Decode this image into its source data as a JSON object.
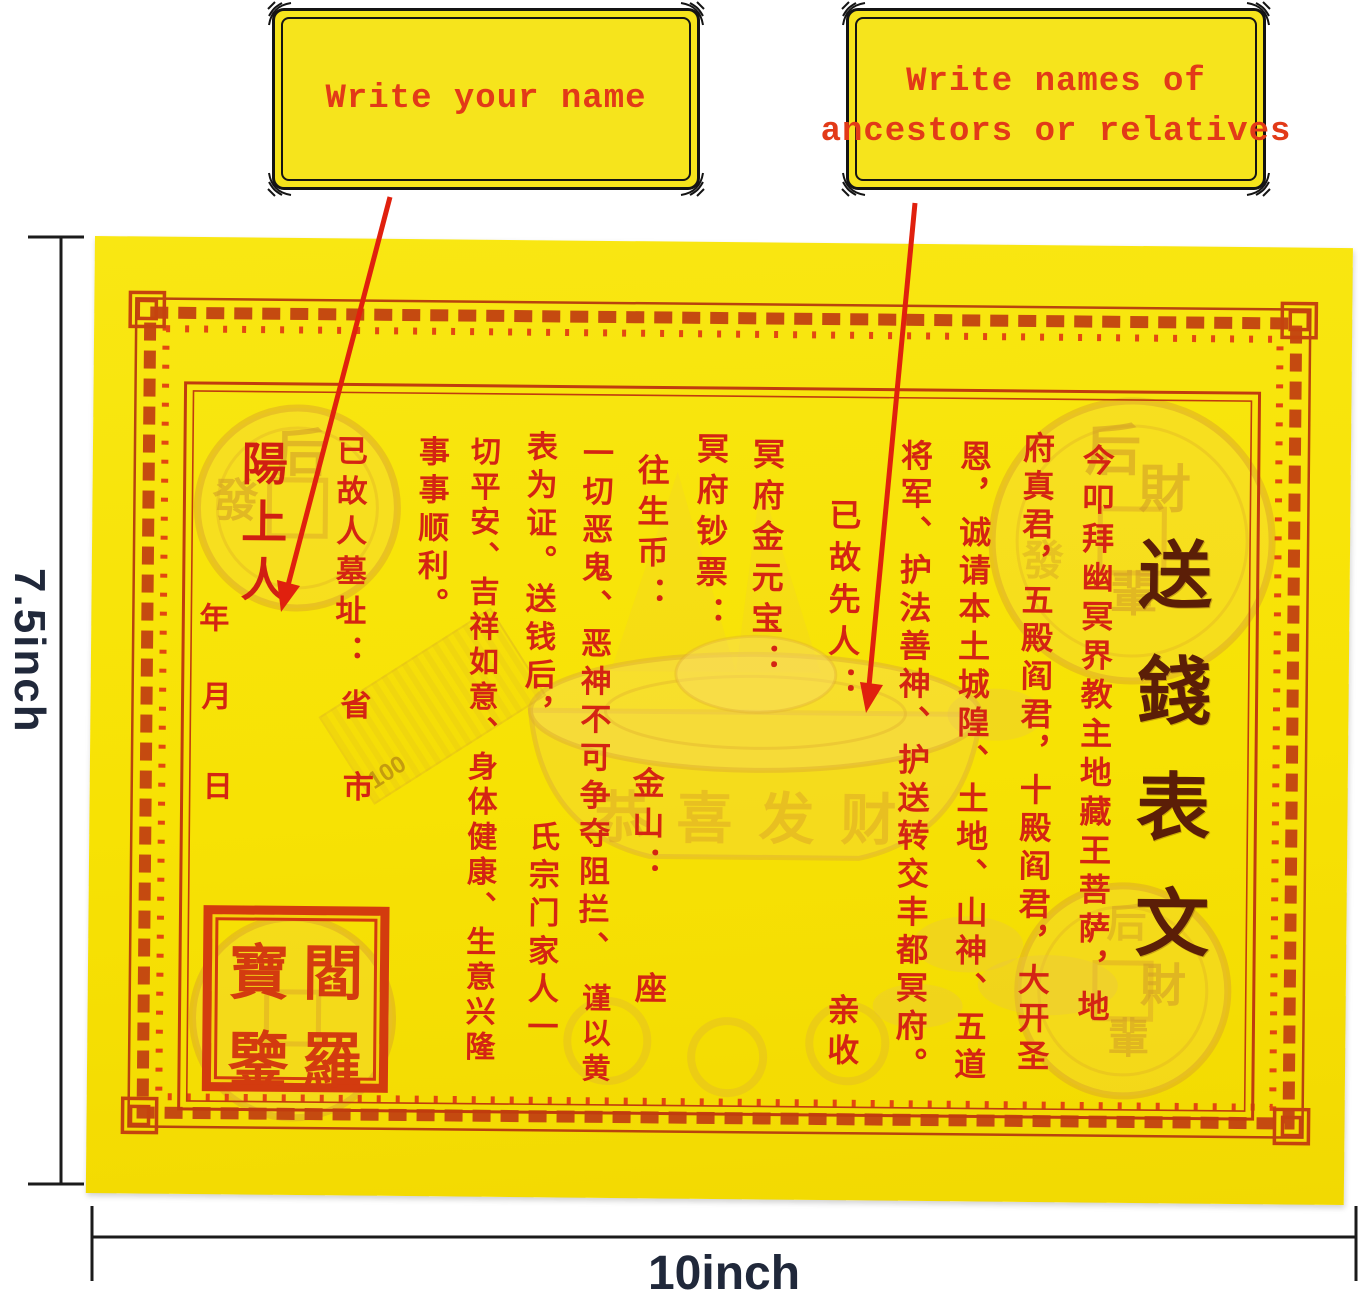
{
  "callouts": {
    "left": {
      "text": "Write your name"
    },
    "right": {
      "line1": "Write names of",
      "line2": "ancestors or relatives"
    }
  },
  "dimensions": {
    "height_label": "7.5inch",
    "width_label": "10inch"
  },
  "paper": {
    "title": "送錢表文",
    "columns": {
      "c1": "今叩拜幽冥界教主地藏王菩萨，地",
      "c2": "府真君，五殿阎君，十殿阎君，大开圣",
      "c3": "恩，诚请本土城隍、土地、山神、五道",
      "c4": "将军、护法善神、护送转交丰都冥府。",
      "c5": "已故先人：",
      "c5b": "亲收",
      "c6": "冥府金元宝：",
      "c7": "冥府钞票：",
      "c8": "往生币：",
      "c8b": "金山：",
      "c8c": "座",
      "c9": "一切恶鬼、恶神不可争夺阻拦、",
      "c9b": "谨以黄",
      "c10": "表为证。送钱后，",
      "c10b": "氏宗门家人一",
      "c11": "切平安、吉祥如意、身体健康、生意兴隆",
      "c12": "事事顺利。",
      "c13": "已故人墓址：",
      "c13b": "省",
      "c13c": "市",
      "c14": "陽上人",
      "c15a": "年",
      "c15b": "月",
      "c15c": "日"
    },
    "seal": {
      "top_left": "寶",
      "top_right": "閻",
      "bottom_left": "鑒",
      "bottom_right": "羅"
    },
    "watermarks": {
      "coin_char_hou": "后",
      "coin_char_cai": "財",
      "coin_char_fa": "發",
      "coin_char_bei": "輩",
      "ingot_blessing": "恭喜发财",
      "bill_value": "100"
    }
  },
  "colors": {
    "paper_yellow": "#f8e30c",
    "print_red": "#d42413",
    "border_red": "#c5470f",
    "title_brown": "#5b1e07",
    "annotation_red": "#e23a18",
    "dimension_dark": "#20283a",
    "callout_yellow": "#f6e41c"
  }
}
